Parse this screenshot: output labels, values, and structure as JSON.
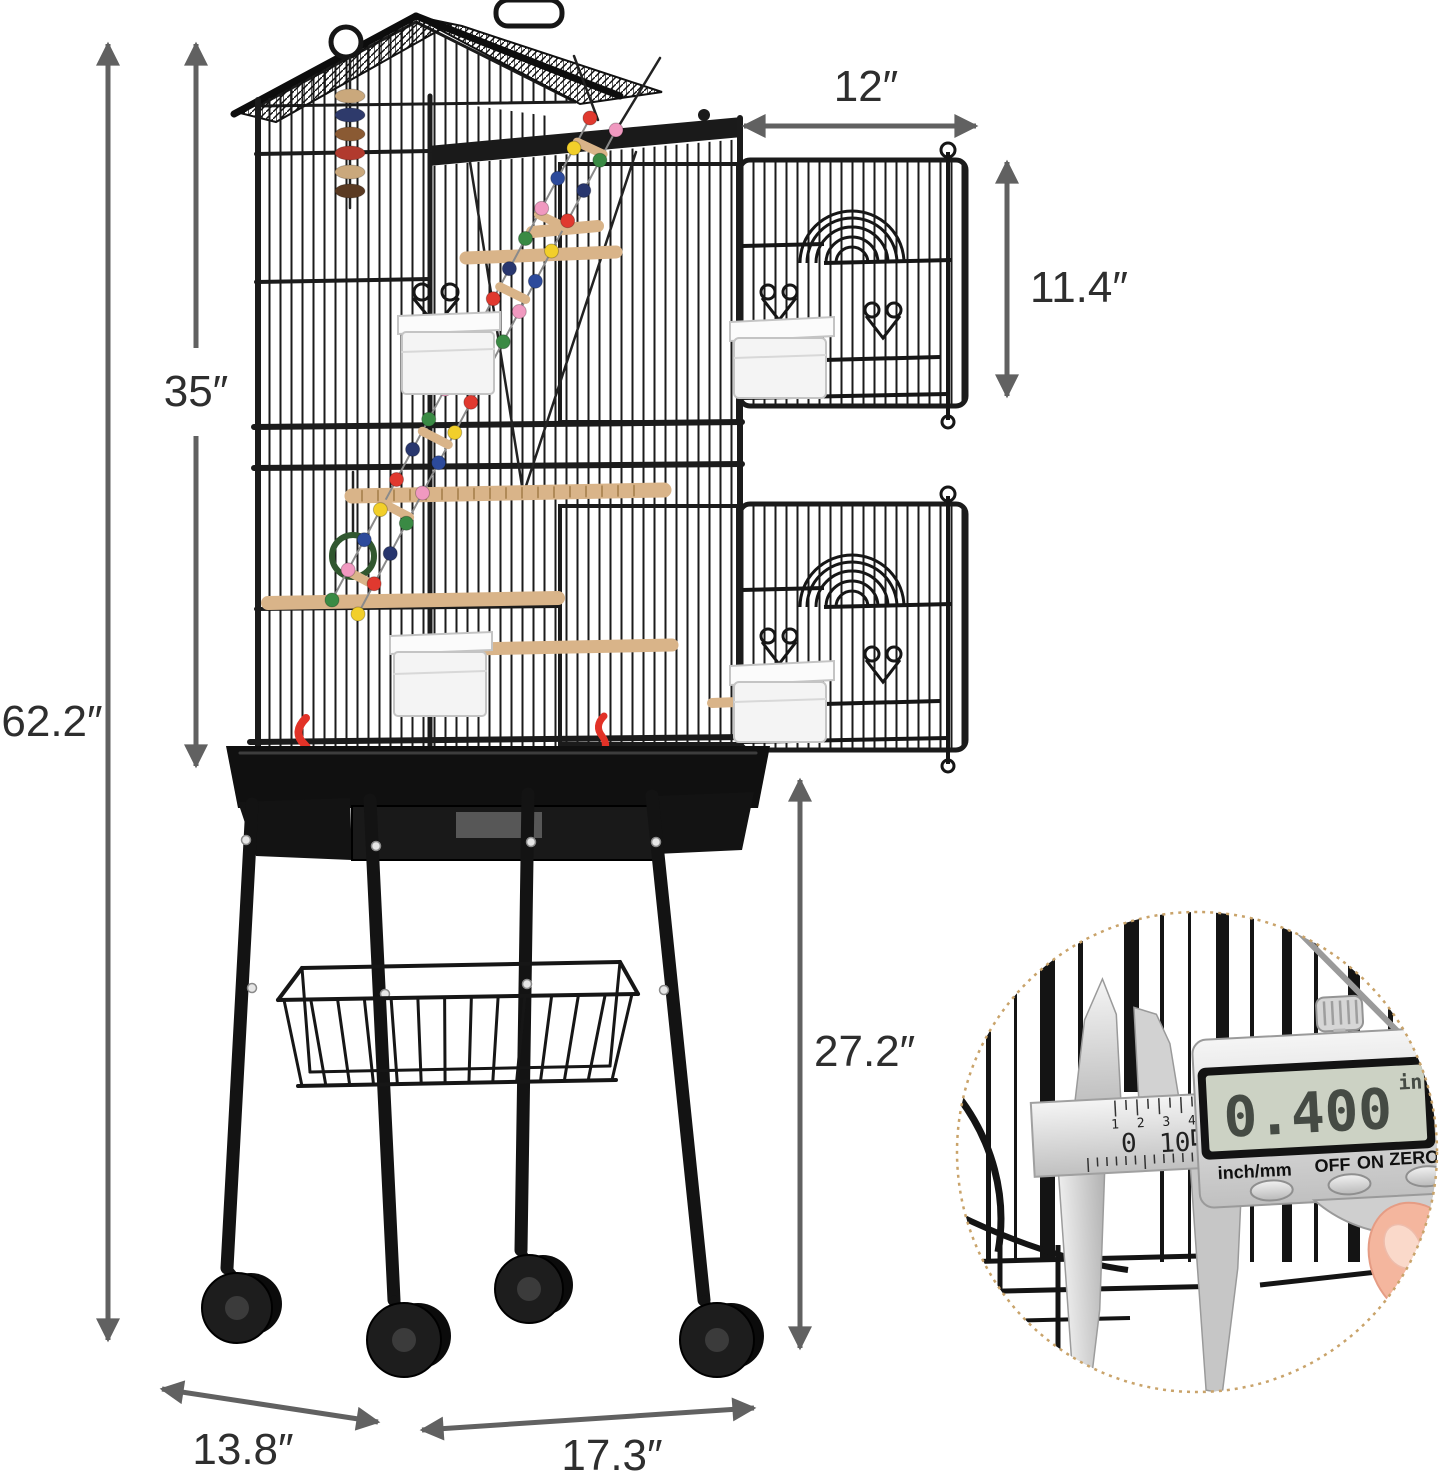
{
  "diagram": {
    "dimensions": {
      "total_height": "62.2″",
      "cage_height": "35″",
      "door_width": "12″",
      "door_height": "11.4″",
      "stand_height": "27.2″",
      "base_depth": "13.8″",
      "base_width": "17.3″"
    },
    "inset_caliper": {
      "display_value": "0.400",
      "unit": "in",
      "mode_button": "inch/mm",
      "off_button": "OFF",
      "on_button": "ON",
      "zero_button": "ZERO",
      "scale_numbers_small": "1 2 3 4",
      "scale_number_left": "0",
      "scale_number_right": "10"
    },
    "colors": {
      "arrow": "#616161",
      "label_text": "#2e2e2e",
      "cage": "#1b1b1b",
      "perch": "#d9b489",
      "accent_red": "#e23227",
      "inset_border": "#c9a36a",
      "lcd_screen": "#ccd2c4",
      "beads": [
        "#e0392f",
        "#f2cf2a",
        "#2c4a9b",
        "#f099c0",
        "#3a8a44",
        "#28366e"
      ],
      "toy_discs": [
        "#caa87c",
        "#2e3a6b",
        "#8a5a33",
        "#b13a2e",
        "#caa87c",
        "#5a3a22"
      ]
    }
  }
}
